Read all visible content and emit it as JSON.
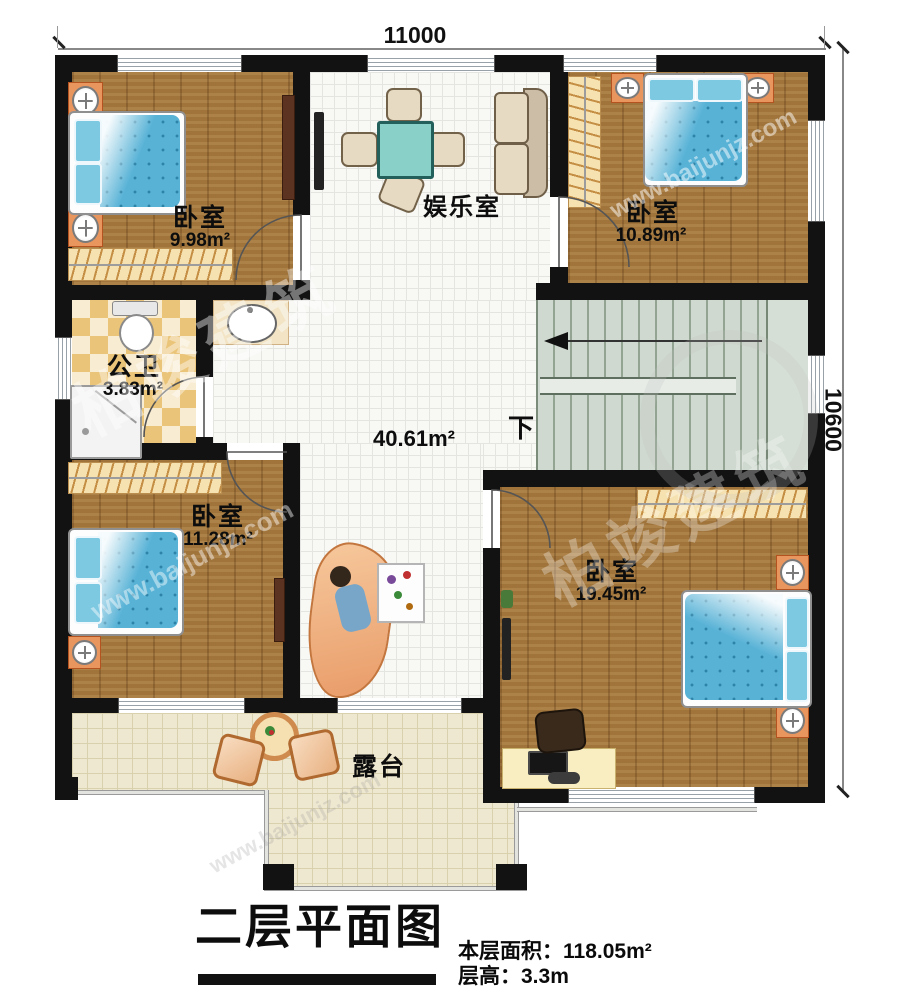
{
  "title": {
    "text": "二层平面图"
  },
  "info": {
    "area_label": "本层面积：",
    "area_value": "118.05m²",
    "height_label": "层高：",
    "height_value": "3.3m"
  },
  "dimensions": {
    "width": "11000",
    "height": "10600"
  },
  "rooms": {
    "bedroom_top_left": {
      "name": "卧室",
      "area": "9.98m²"
    },
    "entertainment": {
      "name": "娱乐室",
      "area": "40.61m²"
    },
    "bedroom_top_right": {
      "name": "卧室",
      "area": "10.89m²"
    },
    "bathroom": {
      "name": "公卫",
      "area": "3.83m²"
    },
    "bedroom_bottom_left": {
      "name": "卧室",
      "area": "11.28m²"
    },
    "bedroom_bottom_right": {
      "name": "卧室",
      "area": "19.45m²"
    },
    "terrace": {
      "name": "露台"
    }
  },
  "stairs": {
    "down_label": "下"
  },
  "watermark": {
    "brand": "柏竣建筑",
    "site": "www.baijunjz.com"
  },
  "colors": {
    "wall": "#121212",
    "wood_floor": "#a87a3e",
    "hall_tile": "#f8f8f5",
    "stair": "#cfd9cf",
    "terrace_tile": "#efe8d1",
    "bathroom_tile": "#eac478",
    "bed_blue": "#57b2d6",
    "table_teal": "#88d0c8",
    "furniture_orange": "#e8955e",
    "wardrobe_cream": "#f6e2b0"
  }
}
